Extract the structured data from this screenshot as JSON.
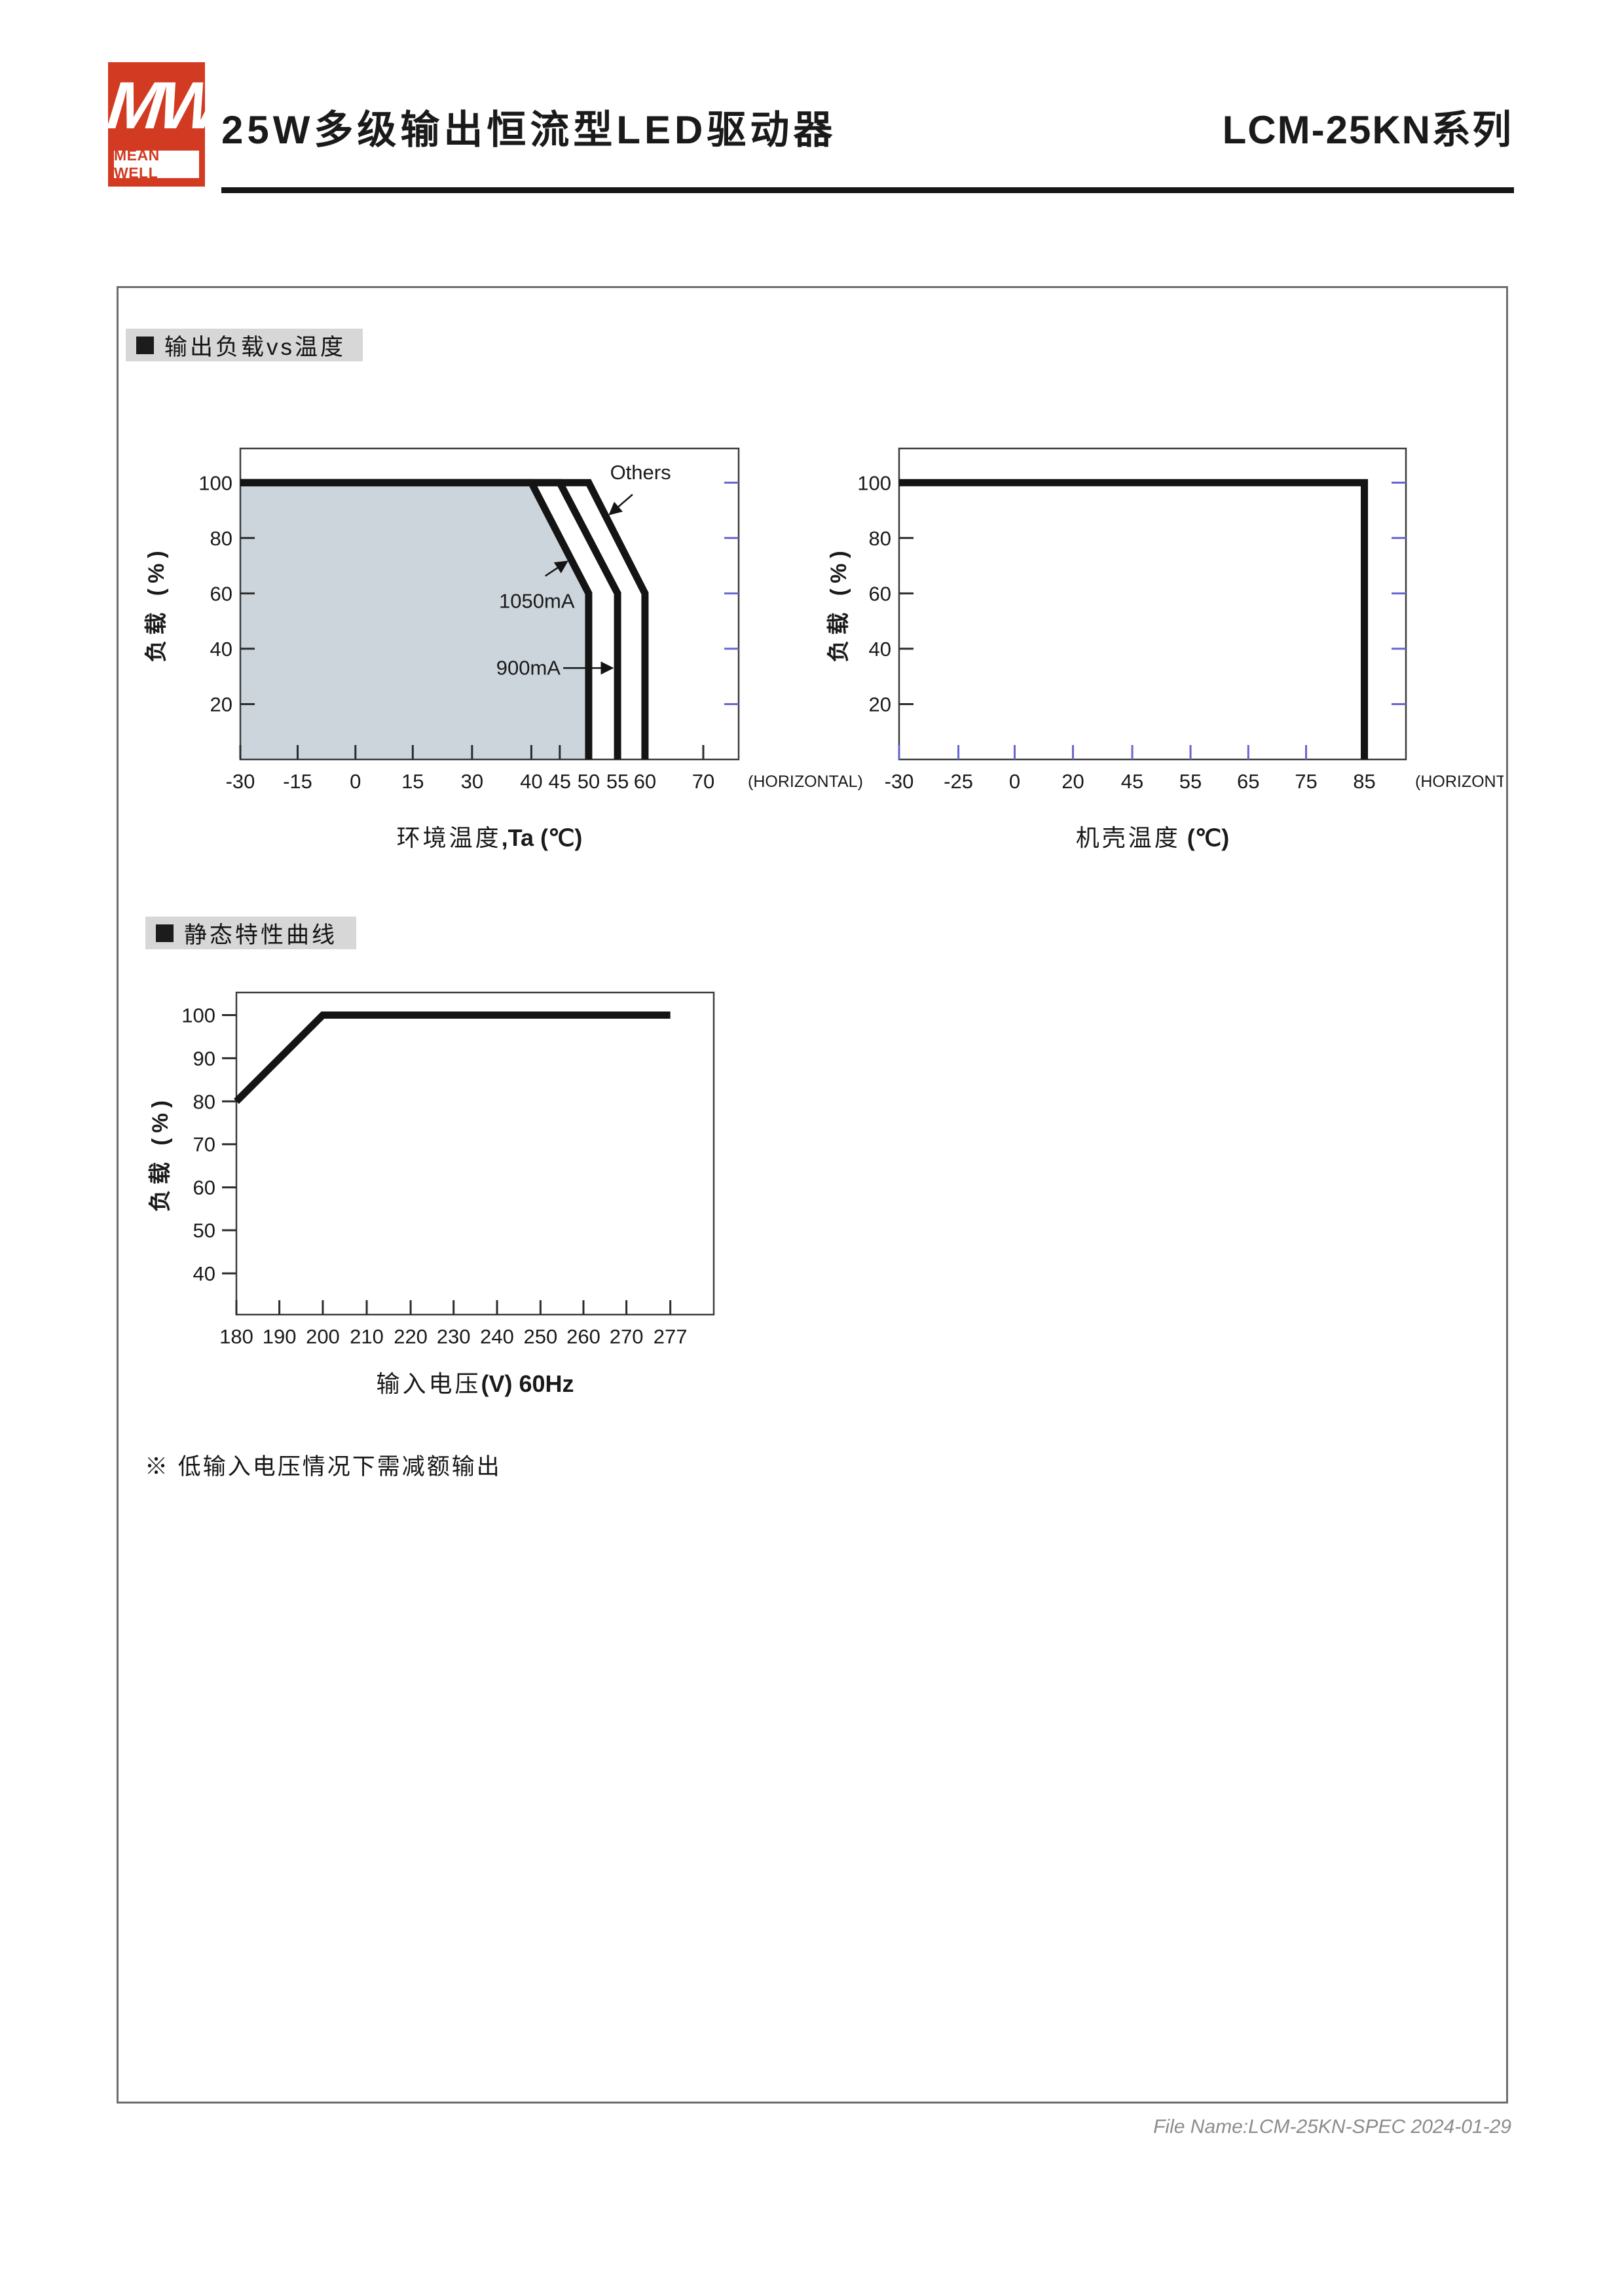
{
  "header": {
    "logo_mw": "MW",
    "logo_text": "MEAN WELL",
    "title": "25W多级输出恒流型LED驱动器",
    "series": "LCM-25KN系列"
  },
  "sections": [
    {
      "title": "输出负载vs温度"
    },
    {
      "title": "静态特性曲线"
    }
  ],
  "note": "※ 低输入电压情况下需减额输出",
  "footer": "File Name:LCM-25KN-SPEC  2024-01-29",
  "colors": {
    "accent_red": "#d33a22",
    "shaded_region": "#cdd5dc",
    "tick_blue": "#6565cf",
    "tick_dark": "#2b2b2b",
    "curve": "#141414",
    "frame": "#3c3c3c",
    "bar_gray": "#d7d7d7"
  },
  "chart_data": [
    {
      "id": "chart-ambient",
      "type": "line",
      "title": "输出负载vs温度 (环境温度)",
      "ylabel_zh": "负载",
      "ylabel_en": " (%)",
      "caption_zh": "环境温度",
      "caption_en": ",Ta (℃)",
      "horizontal_label": "(HORIZONTAL)",
      "xlabel": "环境温度,Ta (℃)",
      "ylabel": "负载 (%)",
      "x_ticks": [
        {
          "v": -30,
          "f": 0.0,
          "label": "-30"
        },
        {
          "v": -15,
          "f": 0.115,
          "label": "-15"
        },
        {
          "v": 0,
          "f": 0.231,
          "label": "0"
        },
        {
          "v": 15,
          "f": 0.346,
          "label": "15"
        },
        {
          "v": 30,
          "f": 0.465,
          "label": "30"
        },
        {
          "v": 40,
          "f": 0.584,
          "label": "40"
        },
        {
          "v": 45,
          "f": 0.641,
          "label": "45"
        },
        {
          "v": 50,
          "f": 0.699,
          "label": "50"
        },
        {
          "v": 55,
          "f": 0.757,
          "label": "55"
        },
        {
          "v": 60,
          "f": 0.812,
          "label": "60"
        },
        {
          "v": 70,
          "f": 0.929,
          "label": "70"
        }
      ],
      "y_ticks": [
        {
          "v": 20,
          "f": 0.178,
          "label": "20"
        },
        {
          "v": 40,
          "f": 0.356,
          "label": "40"
        },
        {
          "v": 60,
          "f": 0.534,
          "label": "60"
        },
        {
          "v": 80,
          "f": 0.712,
          "label": "80"
        },
        {
          "v": 100,
          "f": 0.89,
          "label": "100"
        }
      ],
      "style": {
        "x_tick_color": "dark",
        "y_side": "in",
        "right_ticks": true
      },
      "region": [
        [
          -30,
          0
        ],
        [
          -30,
          100
        ],
        [
          40,
          100
        ],
        [
          50,
          60
        ],
        [
          50,
          0
        ]
      ],
      "series": [
        {
          "name": "1050mA",
          "points": [
            [
              -30,
              100
            ],
            [
              40,
              100
            ],
            [
              50,
              60
            ],
            [
              50,
              0
            ]
          ]
        },
        {
          "name": "900mA",
          "points": [
            [
              -30,
              100
            ],
            [
              45,
              100
            ],
            [
              55,
              60
            ],
            [
              55,
              0
            ]
          ]
        },
        {
          "name": "Others",
          "points": [
            [
              -30,
              100
            ],
            [
              50,
              100
            ],
            [
              60,
              60
            ],
            [
              60,
              0
            ]
          ]
        }
      ],
      "annotations": [
        {
          "text": "Others",
          "tx": 0.803,
          "ty": 0.922,
          "arrow": [
            0.787,
            0.852,
            0.741,
            0.788
          ]
        },
        {
          "text": "1050mA",
          "tx": 0.595,
          "ty": 0.508,
          "arrow": [
            0.612,
            0.59,
            0.656,
            0.637
          ]
        },
        {
          "text": "900mA",
          "tx": 0.578,
          "ty": 0.294,
          "arrow": [
            0.648,
            0.294,
            0.747,
            0.294
          ]
        }
      ]
    },
    {
      "id": "chart-case",
      "type": "line",
      "title": "输出负载vs温度 (机壳温度)",
      "ylabel_zh": "负载",
      "ylabel_en": " (%)",
      "caption_zh": "机壳温度",
      "caption_en": " (℃)",
      "horizontal_label": "(HORIZONTAL)",
      "xlabel": "机壳温度 (℃)",
      "ylabel": "负载 (%)",
      "x_ticks": [
        {
          "v": -30,
          "f": 0.0,
          "label": "-30"
        },
        {
          "v": -25,
          "f": 0.117,
          "label": "-25"
        },
        {
          "v": 0,
          "f": 0.228,
          "label": "0"
        },
        {
          "v": 20,
          "f": 0.343,
          "label": "20"
        },
        {
          "v": 45,
          "f": 0.46,
          "label": "45"
        },
        {
          "v": 55,
          "f": 0.575,
          "label": "55"
        },
        {
          "v": 65,
          "f": 0.689,
          "label": "65"
        },
        {
          "v": 75,
          "f": 0.803,
          "label": "75"
        },
        {
          "v": 85,
          "f": 0.918,
          "label": "85"
        }
      ],
      "y_ticks": [
        {
          "v": 20,
          "f": 0.178,
          "label": "20"
        },
        {
          "v": 40,
          "f": 0.356,
          "label": "40"
        },
        {
          "v": 60,
          "f": 0.534,
          "label": "60"
        },
        {
          "v": 80,
          "f": 0.712,
          "label": "80"
        },
        {
          "v": 100,
          "f": 0.89,
          "label": "100"
        }
      ],
      "style": {
        "x_tick_color": "blue",
        "y_side": "in",
        "right_ticks": true
      },
      "region": null,
      "series": [
        {
          "name": "load",
          "points": [
            [
              -30,
              100
            ],
            [
              85,
              100
            ],
            [
              85,
              0
            ]
          ]
        }
      ],
      "annotations": []
    },
    {
      "id": "chart-voltage",
      "type": "line",
      "title": "静态特性曲线",
      "ylabel_zh": "负载",
      "ylabel_en": " (%)",
      "caption_zh": "输入电压",
      "caption_en": "(V) 60Hz",
      "horizontal_label": null,
      "xlabel": "输入电压(V) 60Hz",
      "ylabel": "负载 (%)",
      "x_ticks": [
        {
          "v": 180,
          "f": 0.0,
          "label": "180"
        },
        {
          "v": 190,
          "f": 0.09,
          "label": "190"
        },
        {
          "v": 200,
          "f": 0.181,
          "label": "200"
        },
        {
          "v": 210,
          "f": 0.273,
          "label": "210"
        },
        {
          "v": 220,
          "f": 0.365,
          "label": "220"
        },
        {
          "v": 230,
          "f": 0.455,
          "label": "230"
        },
        {
          "v": 240,
          "f": 0.546,
          "label": "240"
        },
        {
          "v": 250,
          "f": 0.637,
          "label": "250"
        },
        {
          "v": 260,
          "f": 0.727,
          "label": "260"
        },
        {
          "v": 270,
          "f": 0.817,
          "label": "270"
        },
        {
          "v": 277,
          "f": 0.909,
          "label": "277"
        }
      ],
      "y_ticks": [
        {
          "v": 40,
          "f": 0.128,
          "label": "40"
        },
        {
          "v": 50,
          "f": 0.262,
          "label": "50"
        },
        {
          "v": 60,
          "f": 0.395,
          "label": "60"
        },
        {
          "v": 70,
          "f": 0.529,
          "label": "70"
        },
        {
          "v": 80,
          "f": 0.662,
          "label": "80"
        },
        {
          "v": 90,
          "f": 0.796,
          "label": "90"
        },
        {
          "v": 100,
          "f": 0.93,
          "label": "100"
        }
      ],
      "style": {
        "x_tick_color": "dark",
        "y_side": "out",
        "right_ticks": false
      },
      "region": null,
      "series": [
        {
          "name": "load",
          "points": [
            [
              180,
              80
            ],
            [
              200,
              100
            ],
            [
              277,
              100
            ]
          ]
        }
      ],
      "annotations": []
    }
  ]
}
